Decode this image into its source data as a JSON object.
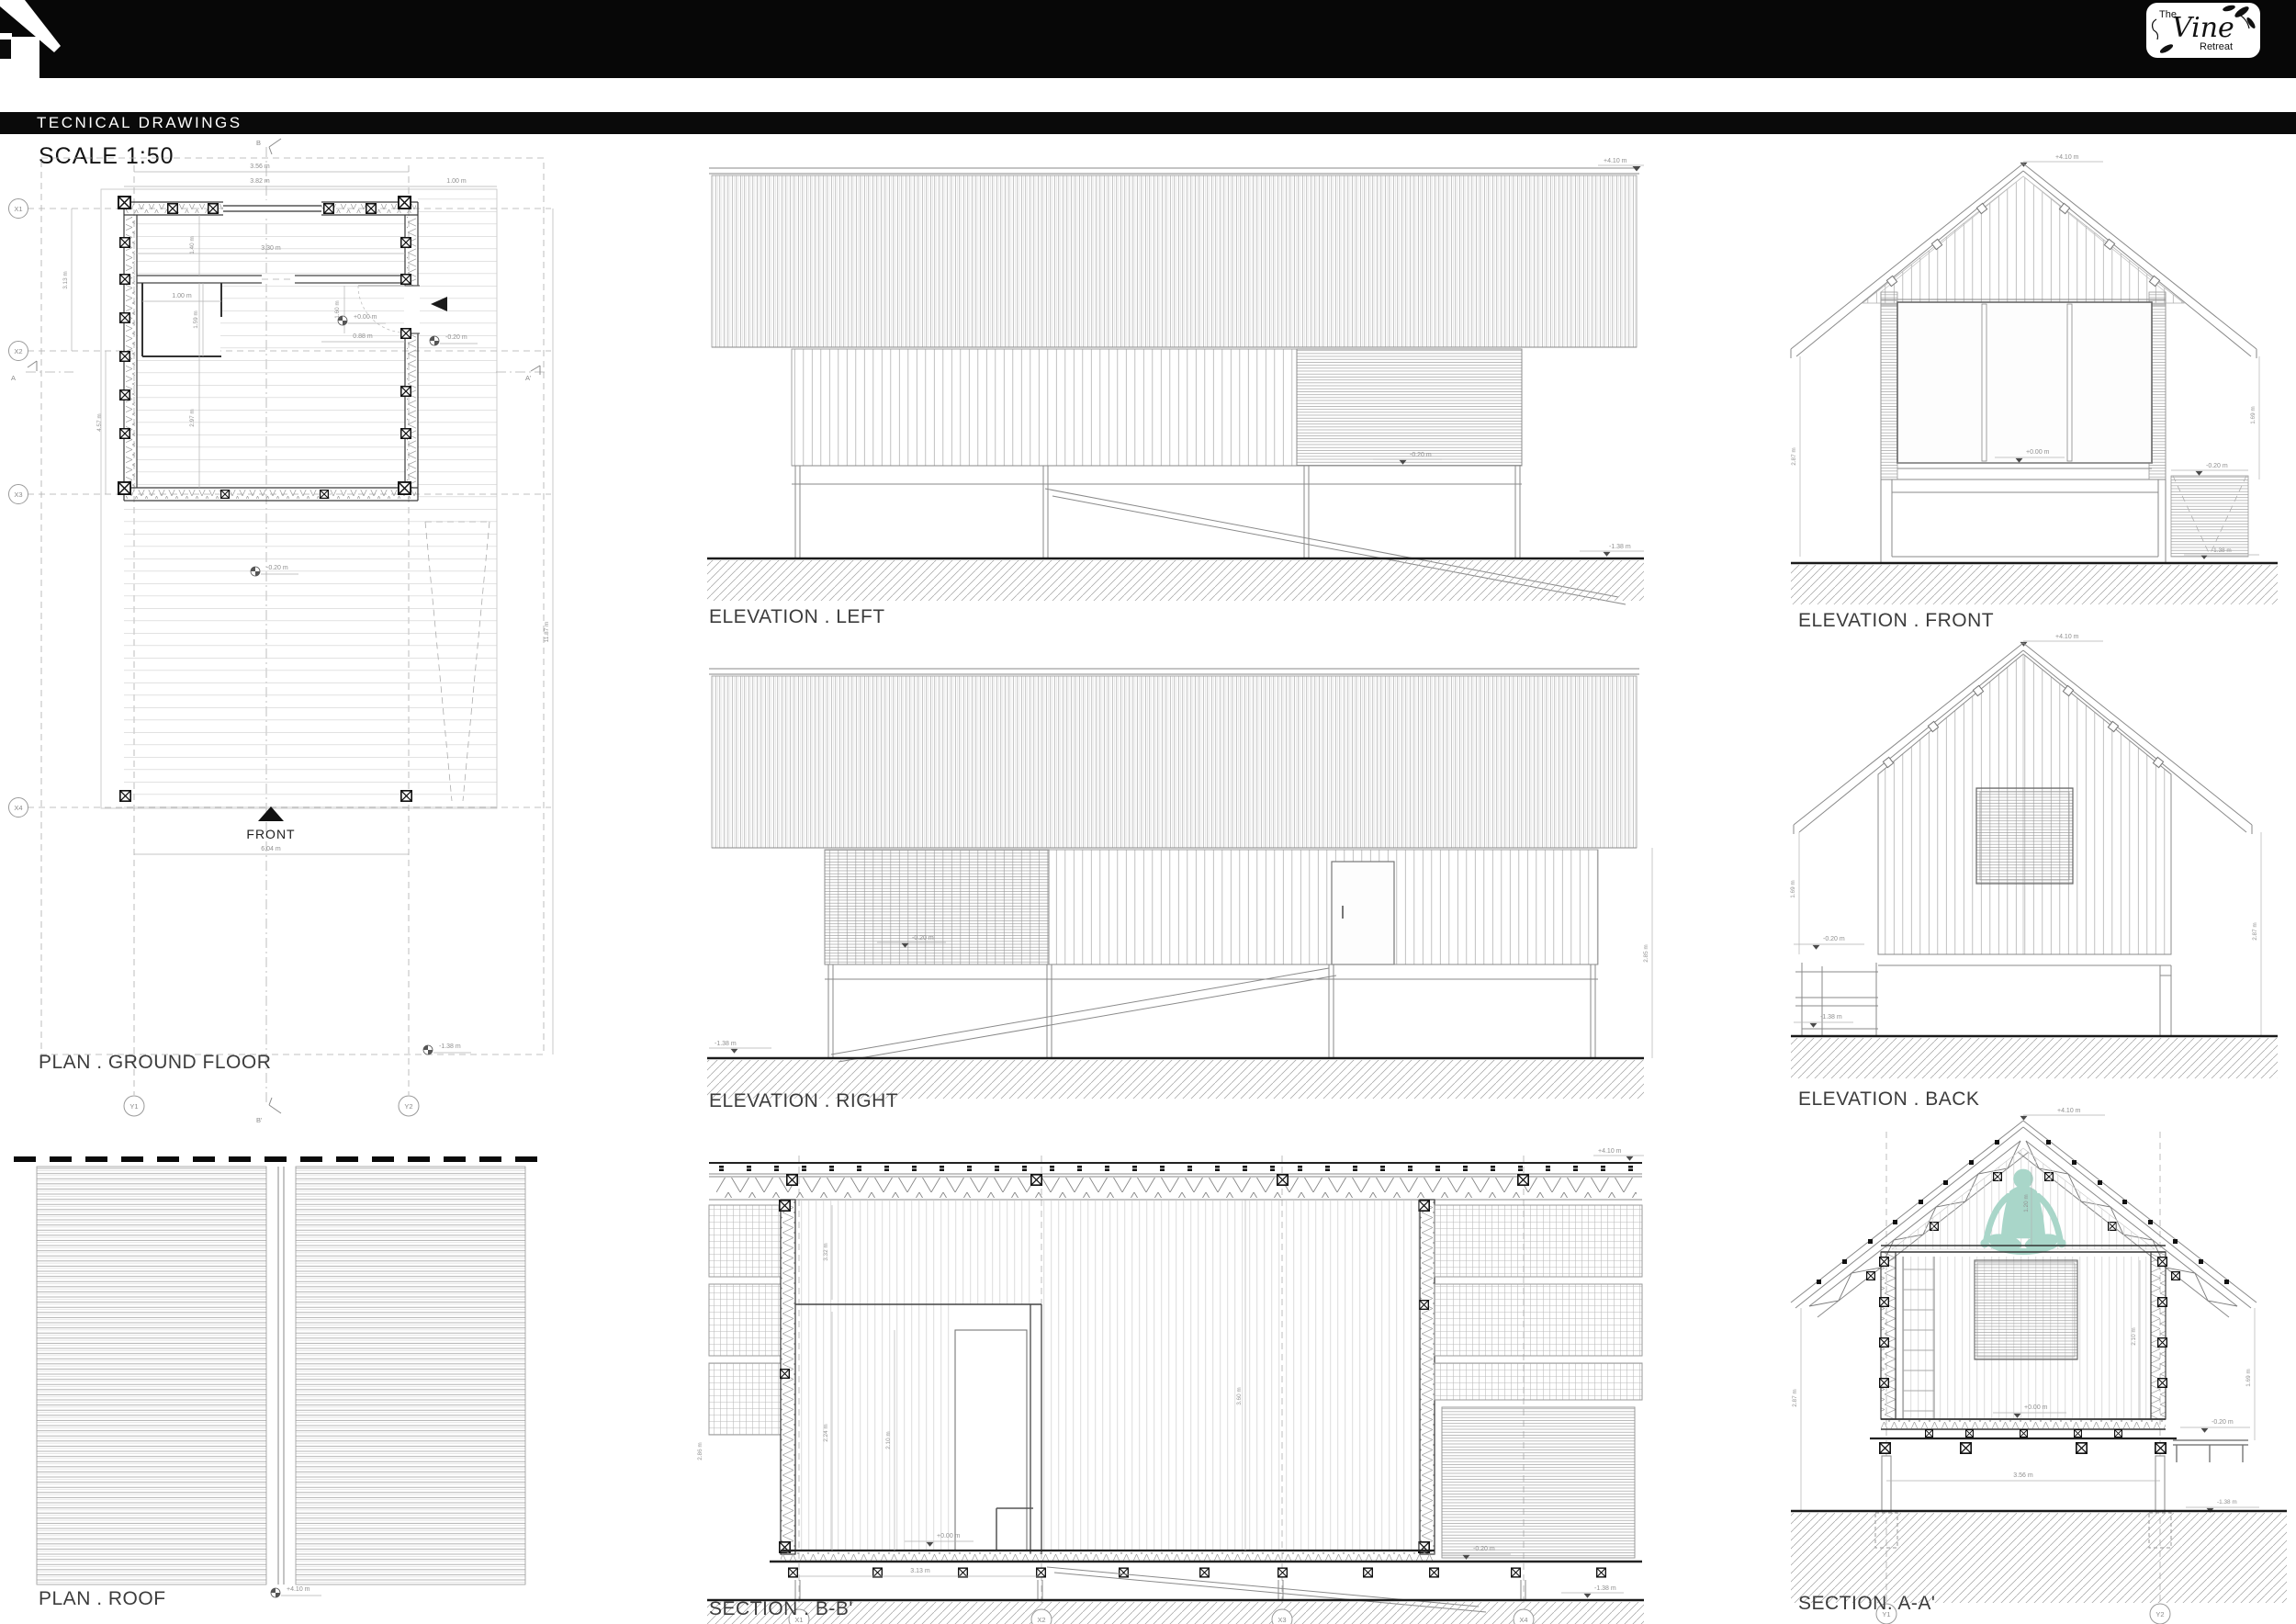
{
  "header": {
    "title": "TECNICAL DRAWINGS",
    "scale": "SCALE 1:50",
    "logo": {
      "line1": "The",
      "line2": "Vine",
      "line3": "Retreat"
    }
  },
  "levels": {
    "p410": "+4.10 m",
    "p000": "+0.00 m",
    "m020": "-0.20 m",
    "m138": "-1.38 m"
  },
  "plan_ground": {
    "label": "PLAN . GROUND FLOOR",
    "front": "FRONT",
    "grid": {
      "x1": "X1",
      "x2": "X2",
      "x3": "X3",
      "x4": "X4",
      "y1": "Y1",
      "y2": "Y2",
      "a": "A",
      "a2": "A'",
      "b": "B",
      "b2": "B'"
    },
    "dims": {
      "d356": "3.56 m",
      "d382": "3.82 m",
      "d100": "1.00 m",
      "d330": "3.30 m",
      "d140": "1.40 m",
      "d100b": "1.00 m",
      "d159": "1.59 m",
      "d160": "1.60 m",
      "d088": "0.88 m",
      "d297": "2.97 m",
      "d313": "3.13 m",
      "d457": "4.57 m",
      "d1187": "11.87 m",
      "d604": "6.04 m"
    }
  },
  "plan_roof": {
    "label": "PLAN . ROOF"
  },
  "elev_left": {
    "label": "ELEVATION . LEFT"
  },
  "elev_right": {
    "label": "ELEVATION . RIGHT",
    "dims": {
      "d285": "2.85 m"
    }
  },
  "elev_front": {
    "label": "ELEVATION . FRONT",
    "dims": {
      "d287": "2.87 m",
      "d169": "1.69 m"
    }
  },
  "elev_back": {
    "label": "ELEVATION . BACK",
    "dims": {
      "d169": "1.69 m",
      "d287": "2.87 m"
    }
  },
  "section_bb": {
    "label": "SECTION . B-B'",
    "dims": {
      "d332": "3.32 m",
      "d224": "2.24 m",
      "d210": "2.10 m",
      "d360": "3.60 m",
      "d313": "3.13 m",
      "d286": "2.86 m"
    }
  },
  "section_aa": {
    "label": "SECTION. A-A'",
    "dims": {
      "d120": "1.20 m",
      "d210": "2.10 m",
      "d356": "3.56 m",
      "d287": "2.87 m",
      "d169": "1.69 m"
    }
  }
}
